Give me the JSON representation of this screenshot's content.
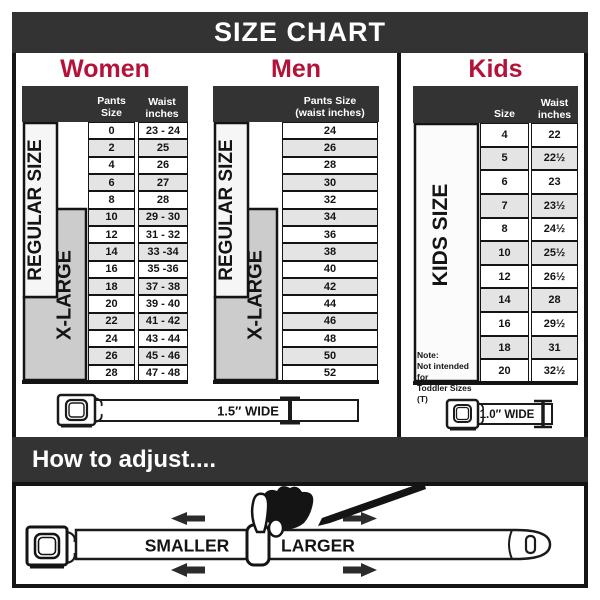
{
  "title": "SIZE CHART",
  "colors": {
    "accent_red": "#b5123a",
    "bar_dark": "#333333",
    "row_alt_gray": "#e4e4e4",
    "xlarge_box_gray": "#cccccc",
    "regular_box_light": "#f6f6f6",
    "border_black": "#141414"
  },
  "icons": {
    "buckle": "seatbelt-buckle-rounded-square",
    "width_measure": "i-beam-height-gauge",
    "adjust_hand": "pinching-hand",
    "arrow": "bold-horizontal-arrow"
  },
  "women": {
    "heading": "Women",
    "pants_header": "Pants Size",
    "waist_header_line1": "Waist",
    "waist_header_line2": "inches",
    "regular_label": "REGULAR SIZE",
    "xlarge_label": "X-LARGE",
    "belt_width_label": "1.5″ WIDE",
    "rows": [
      {
        "size": "0",
        "waist": "23 - 24"
      },
      {
        "size": "2",
        "waist": "25"
      },
      {
        "size": "4",
        "waist": "26"
      },
      {
        "size": "6",
        "waist": "27"
      },
      {
        "size": "8",
        "waist": "28"
      },
      {
        "size": "10",
        "waist": "29 - 30"
      },
      {
        "size": "12",
        "waist": "31 - 32"
      },
      {
        "size": "14",
        "waist": "33 -34"
      },
      {
        "size": "16",
        "waist": "35 -36"
      },
      {
        "size": "18",
        "waist": "37 - 38"
      },
      {
        "size": "20",
        "waist": "39 - 40"
      },
      {
        "size": "22",
        "waist": "41 - 42"
      },
      {
        "size": "24",
        "waist": "43 - 44"
      },
      {
        "size": "26",
        "waist": "45 - 46"
      },
      {
        "size": "28",
        "waist": "47 - 48"
      }
    ]
  },
  "men": {
    "heading": "Men",
    "header_line1": "Pants Size",
    "header_line2": "(waist inches)",
    "regular_label": "REGULAR SIZE",
    "xlarge_label": "X-LARGE",
    "rows": [
      "24",
      "26",
      "28",
      "30",
      "32",
      "34",
      "36",
      "38",
      "40",
      "42",
      "44",
      "46",
      "48",
      "50",
      "52"
    ]
  },
  "kids": {
    "heading": "Kids",
    "size_header": "Size",
    "waist_header_line1": "Waist",
    "waist_header_line2": "inches",
    "side_label": "KIDS SIZE",
    "note_lines": [
      "Note:",
      "Not intended for",
      "Toddler Sizes (T)"
    ],
    "belt_width_label": "1.0″ WIDE",
    "rows": [
      {
        "size": "4",
        "waist": "22"
      },
      {
        "size": "5",
        "waist": "22½"
      },
      {
        "size": "6",
        "waist": "23"
      },
      {
        "size": "7",
        "waist": "23½"
      },
      {
        "size": "8",
        "waist": "24½"
      },
      {
        "size": "10",
        "waist": "25½"
      },
      {
        "size": "12",
        "waist": "26½"
      },
      {
        "size": "14",
        "waist": "28"
      },
      {
        "size": "16",
        "waist": "29½"
      },
      {
        "size": "18",
        "waist": "31"
      },
      {
        "size": "20",
        "waist": "32½"
      }
    ]
  },
  "adjust": {
    "heading": "How to adjust....",
    "smaller_label": "SMALLER",
    "larger_label": "LARGER"
  }
}
